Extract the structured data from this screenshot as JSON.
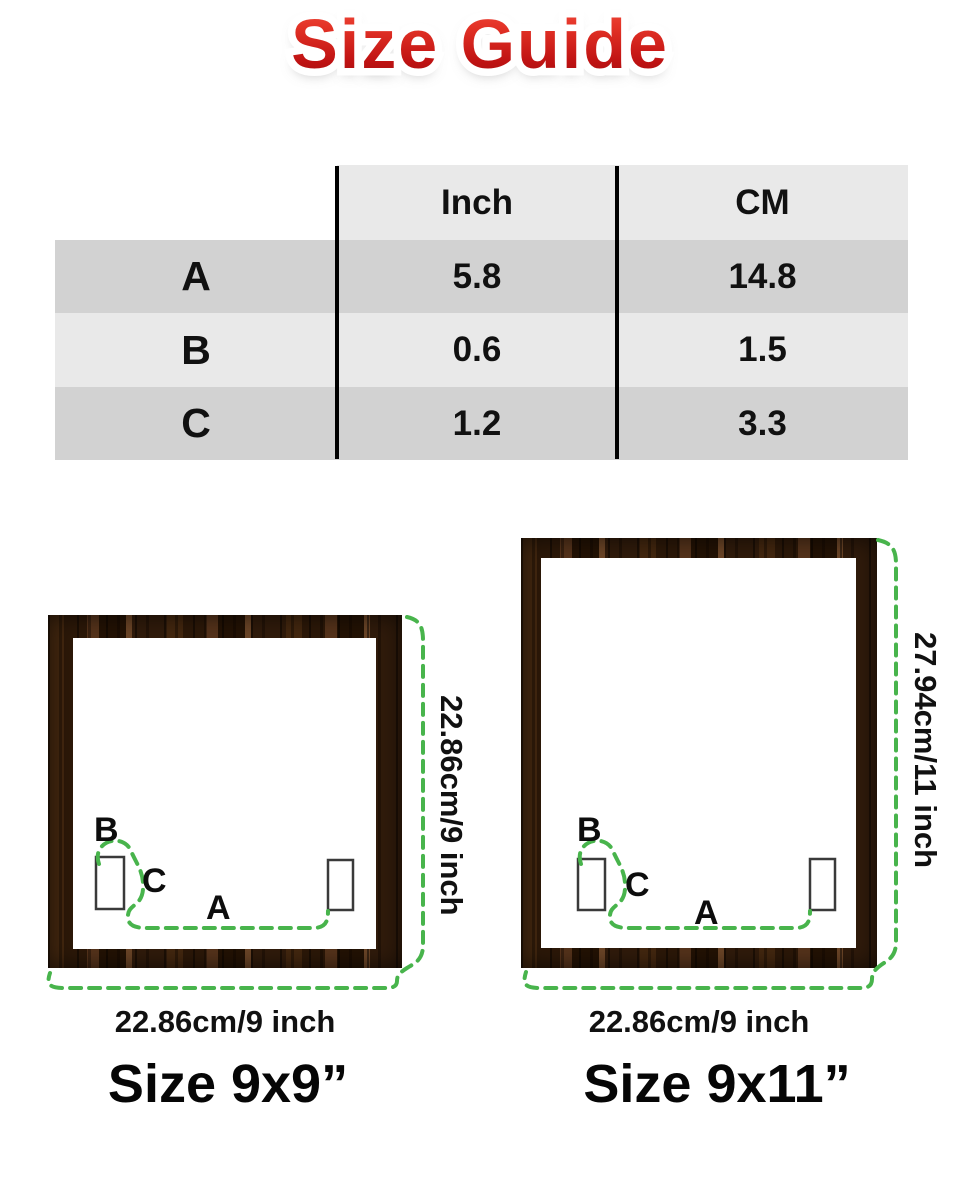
{
  "title": {
    "text": "Size Guide"
  },
  "table": {
    "headers": {
      "col1": "",
      "inch": "Inch",
      "cm": "CM"
    },
    "rows": [
      {
        "label": "A",
        "inch": "5.8",
        "cm": "14.8"
      },
      {
        "label": "B",
        "inch": "0.6",
        "cm": "1.5"
      },
      {
        "label": "C",
        "inch": "1.2",
        "cm": "3.3"
      }
    ]
  },
  "frames": {
    "left": {
      "height_label": "22.86cm/9 inch",
      "width_label": "22.86cm/9 inch",
      "size_label": "Size 9x9”",
      "marker_a": "A",
      "marker_b": "B",
      "marker_c": "C"
    },
    "right": {
      "height_label": "27.94cm/11 inch",
      "width_label": "22.86cm/9 inch",
      "size_label": "Size 9x11”",
      "marker_a": "A",
      "marker_b": "B",
      "marker_c": "C"
    }
  },
  "colors": {
    "accent_green": "#48b44c",
    "title_red_top": "#f25042",
    "title_red_bottom": "#9d0c0e",
    "table_row_dark": "#d2d2d2",
    "table_row_light": "#e9e9e9",
    "wood_brown": "#2b1709"
  }
}
